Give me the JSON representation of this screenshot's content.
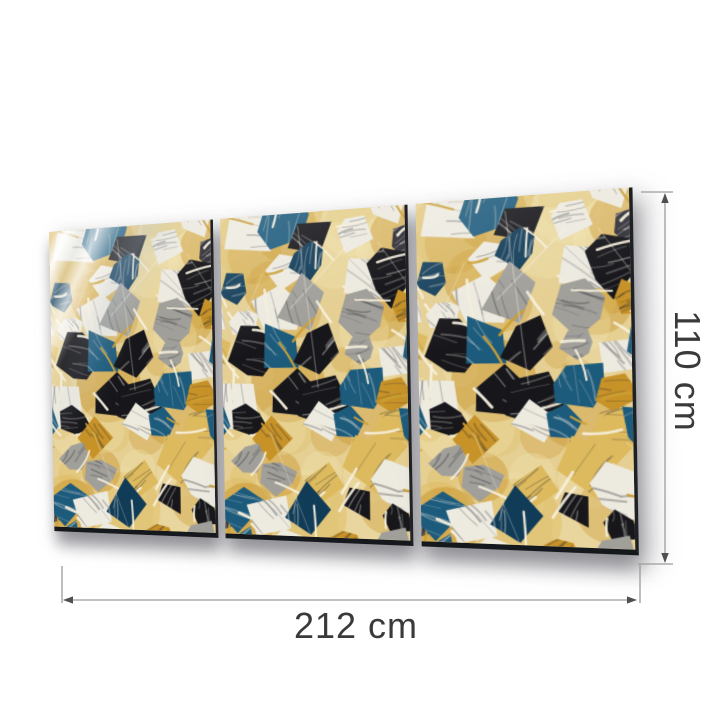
{
  "product": {
    "name": "Abstract Mosaic Triptych Glass Wall Art",
    "panel_count": 3,
    "panels": [
      "left",
      "center",
      "right"
    ],
    "wall_color": "#ffffff",
    "edge_color": "#1d2025",
    "palette": {
      "base_gold": "#e5cf92",
      "ink": "#17171b",
      "charcoal": "#33333a",
      "paper": "#edeae0",
      "silver": "#a09f9a",
      "petrol": "#1d5b7c",
      "navy": "#113c58",
      "gold": "#c79228",
      "sand": "#ddba5e",
      "grout": "#f7f1de"
    }
  },
  "dimensions": {
    "width_label": "212 cm",
    "height_label": "110 cm"
  },
  "annotation": {
    "line_color": "#9c9c9c",
    "arrow_color": "#4f4f4f",
    "text_color": "#3a3a3a"
  }
}
